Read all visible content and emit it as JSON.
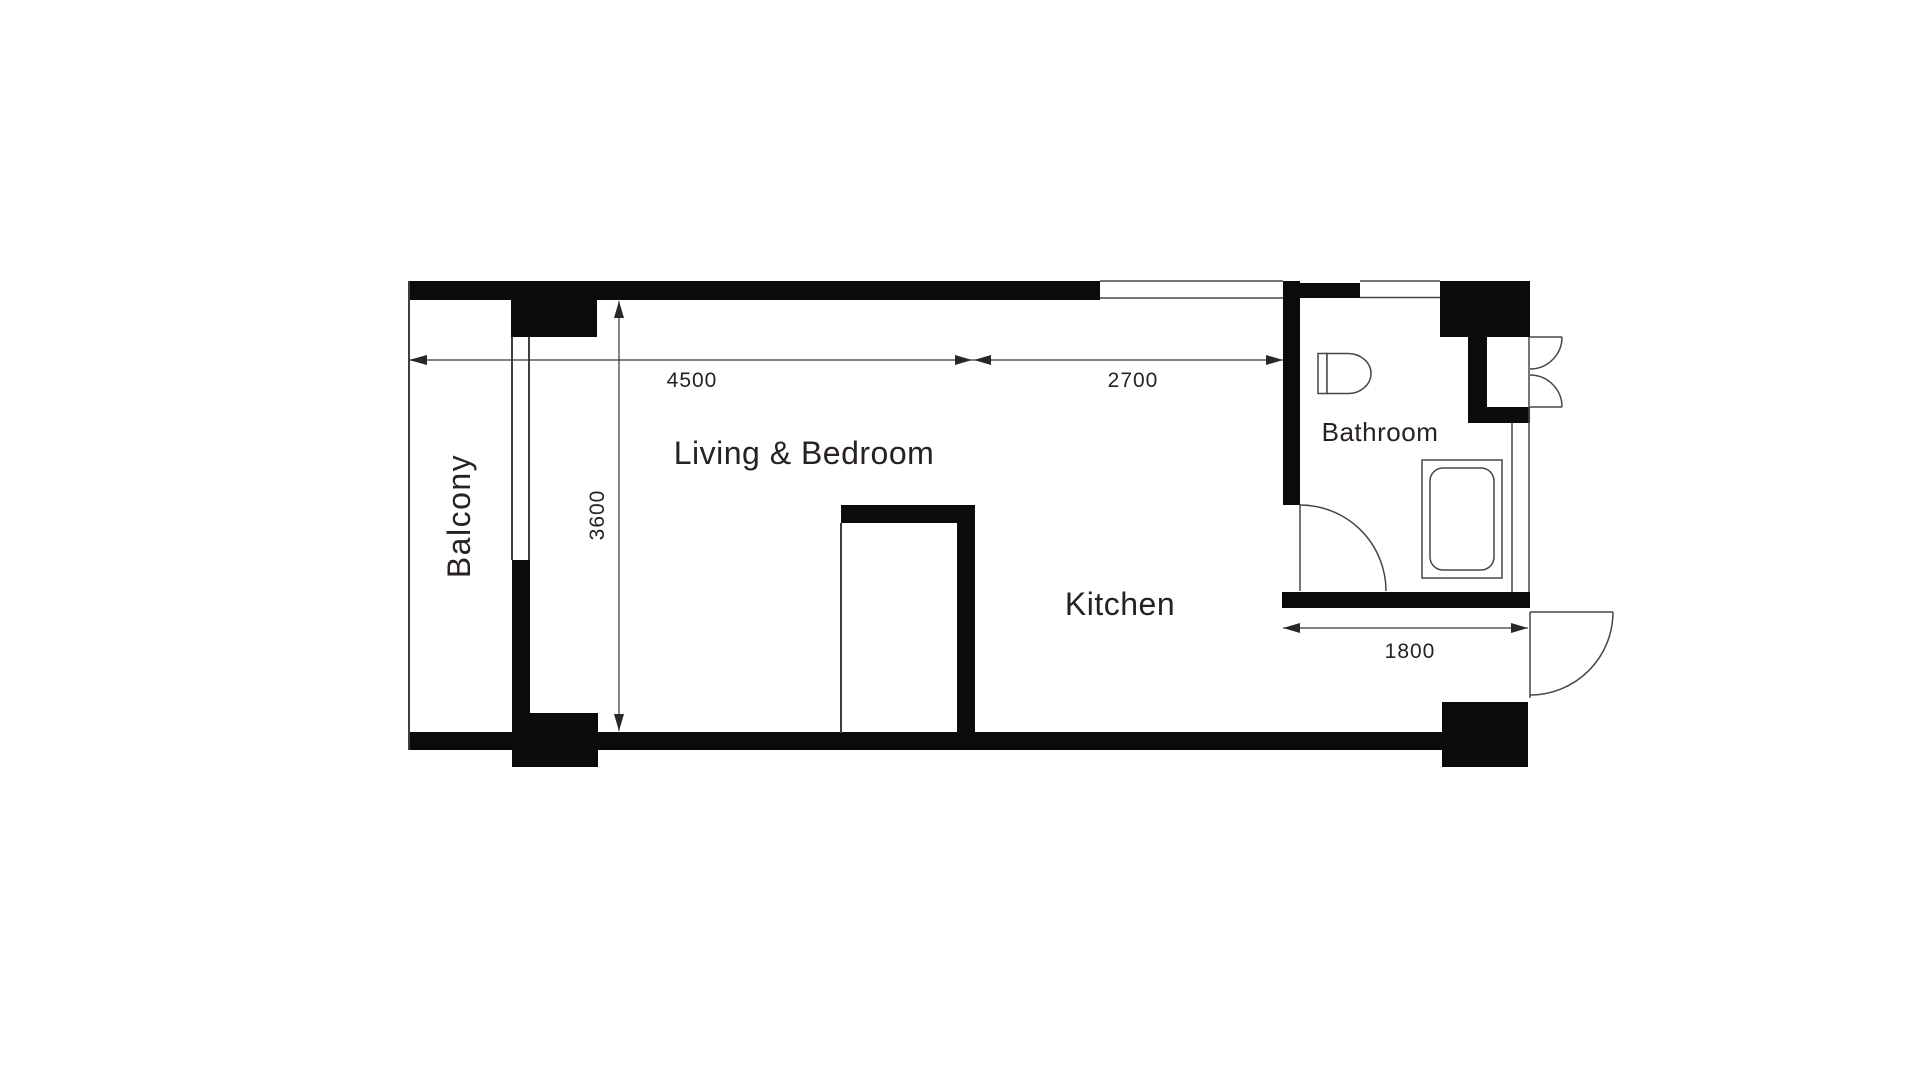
{
  "colors": {
    "background": "#ffffff",
    "wall": "#0b0b0b",
    "thin_line": "#423e3a",
    "text": "#272220"
  },
  "rooms": {
    "balcony": {
      "label": "Balcony"
    },
    "living_bedroom": {
      "label": "Living & Bedroom"
    },
    "kitchen": {
      "label": "Kitchen"
    },
    "bathroom": {
      "label": "Bathroom"
    }
  },
  "dimensions": {
    "living_width": {
      "value": "4500",
      "orientation": "horizontal"
    },
    "kitchen_width": {
      "value": "2700",
      "orientation": "horizontal"
    },
    "living_depth": {
      "value": "3600",
      "orientation": "vertical"
    },
    "entry_width": {
      "value": "1800",
      "orientation": "horizontal"
    }
  },
  "fixtures": {
    "toilet": "toilet",
    "bathtub": "bathtub",
    "bathroom_door": "swing-door",
    "entrance_door": "swing-door",
    "shaft_doors": "double-swing-door",
    "balcony_opening": "sliding-window"
  }
}
